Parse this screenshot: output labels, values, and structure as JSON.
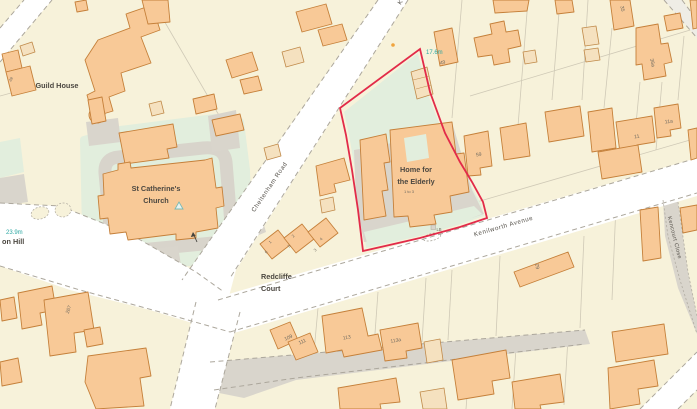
{
  "map": {
    "type": "site-location-plan",
    "place_labels": {
      "guild_house": "Guild House",
      "church_line1": "St Catherine's",
      "church_line2": "Church",
      "home_line1": "Home for",
      "home_line2": "the Elderly",
      "home_sub": "1 to 3",
      "redcliffe_line1": "Redcliffe",
      "redcliffe_line2": "Court"
    },
    "road_labels": {
      "cheltenham": "Cheltenham Road",
      "kenilworth": "Kenilworth Avenue",
      "kencourt": "Kencourt Close",
      "on_hill": "on Hill",
      "partial_top": "K"
    },
    "spot_heights": {
      "junction": "23.9m",
      "site": "17.6m"
    },
    "map_symbols": {
      "letter_box": "LB"
    },
    "house_numbers": {
      "n28": "28",
      "n49": "49",
      "n59": "59",
      "n35": "35",
      "n36a": "36a",
      "n11": "11",
      "n11a": "11a",
      "n62": "62",
      "n267": "267",
      "n109": "109",
      "n111": "111",
      "n113": "113",
      "n113a": "113a",
      "r1": "1",
      "r2": "2",
      "r3": "3",
      "r4": "4",
      "r5": "5",
      "r6": "6"
    },
    "colors": {
      "background": "#f7f2da",
      "building_fill": "#f8c997",
      "building_stroke": "#c5803a",
      "building_light_fill": "#f5e1bf",
      "road_white": "#ffffff",
      "road_gray": "#d9d5cc",
      "road_edge": "#aca79c",
      "green_space": "#e2eedd",
      "parcel_line": "#cfc9b6",
      "boundary_red": "#e22b49",
      "spot_height_teal": "#2ba7a2",
      "label_text": "#4b4740"
    }
  }
}
